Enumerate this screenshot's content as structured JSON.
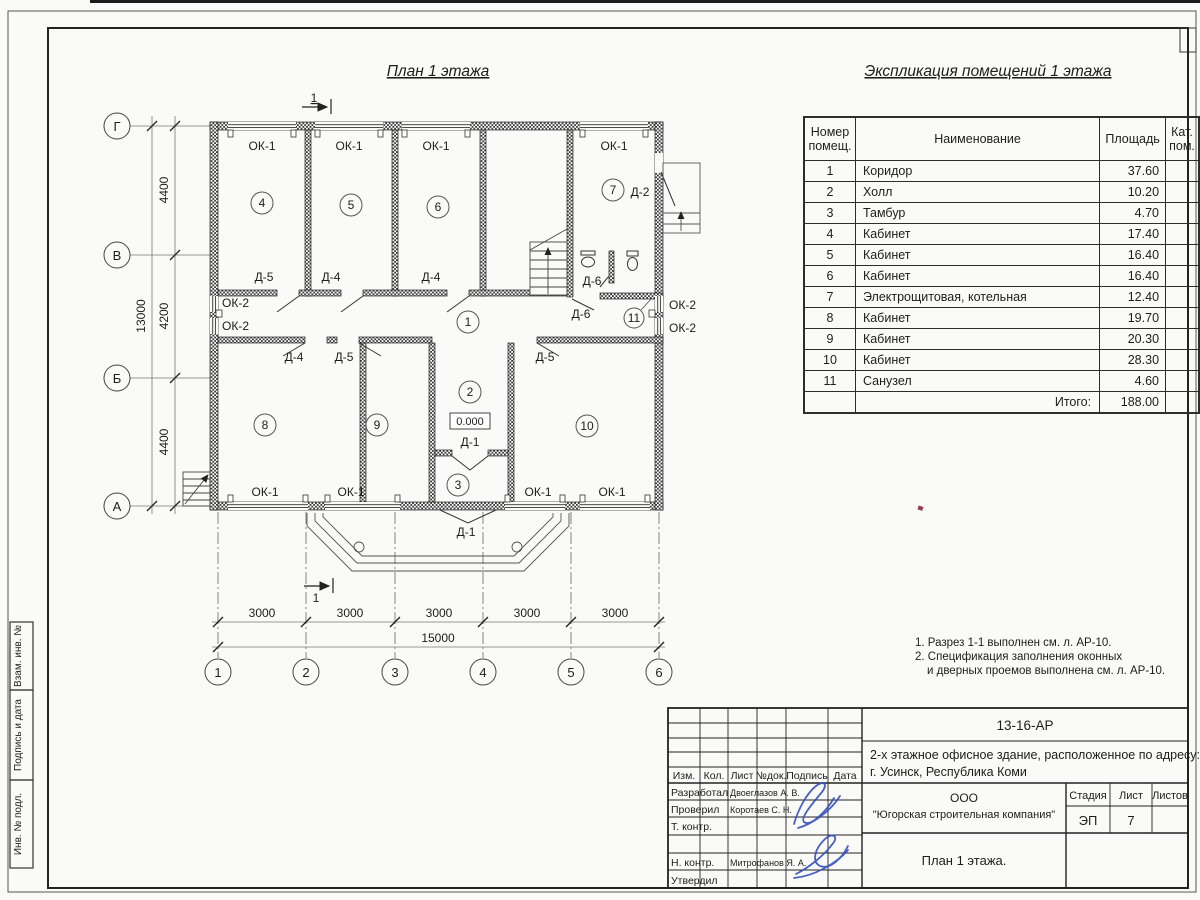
{
  "sheet": {
    "plan_title": "План 1 этажа",
    "table_title": "Экспликация помещений 1 этажа"
  },
  "plan": {
    "axes_rows": [
      "Г",
      "В",
      "Б",
      "А"
    ],
    "axes_cols": [
      "1",
      "2",
      "3",
      "4",
      "5",
      "6"
    ],
    "dims": {
      "v": [
        "4400",
        "4200",
        "4400"
      ],
      "v_total": "13000",
      "h": [
        "3000",
        "3000",
        "3000",
        "3000",
        "3000"
      ],
      "h_total": "15000"
    },
    "labels": {
      "ok1": "ОК-1",
      "ok2": "ОК-2",
      "d1": "Д-1",
      "d2": "Д-2",
      "d4": "Д-4",
      "d5": "Д-5",
      "d6": "Д-6",
      "elevation": "0.000",
      "section": "1"
    }
  },
  "table": {
    "headers": {
      "num": "Номер помещ.",
      "name": "Наименование",
      "area": "Площадь",
      "cat": "Кат. пом."
    },
    "rows": [
      {
        "num": "1",
        "name": "Коридор",
        "area": "37.60"
      },
      {
        "num": "2",
        "name": "Холл",
        "area": "10.20"
      },
      {
        "num": "3",
        "name": "Тамбур",
        "area": "4.70"
      },
      {
        "num": "4",
        "name": "Кабинет",
        "area": "17.40"
      },
      {
        "num": "5",
        "name": "Кабинет",
        "area": "16.40"
      },
      {
        "num": "6",
        "name": "Кабинет",
        "area": "16.40"
      },
      {
        "num": "7",
        "name": "Электрощитовая, котельная",
        "area": "12.40"
      },
      {
        "num": "8",
        "name": "Кабинет",
        "area": "19.70"
      },
      {
        "num": "9",
        "name": "Кабинет",
        "area": "20.30"
      },
      {
        "num": "10",
        "name": "Кабинет",
        "area": "28.30"
      },
      {
        "num": "11",
        "name": "Санузел",
        "area": "4.60"
      }
    ],
    "total_label": "Итого:",
    "total_value": "188.00"
  },
  "notes": [
    "1. Разрез 1-1 выполнен см. л. АР-10.",
    "2. Спецификация заполнения оконных",
    "и дверных проемов выполнена см. л. АР-10."
  ],
  "titleblock": {
    "doc_number": "13-16-АР",
    "project_line1": "2-х этажное офисное здание, расположенное по адресу:",
    "project_line2": "г. Усинск, Республика Коми",
    "columns": [
      "Изм.",
      "Кол.",
      "Лист",
      "№док.",
      "Подпись",
      "Дата"
    ],
    "rows": [
      {
        "role": "Разработал",
        "name": "Двоеглазов А. В."
      },
      {
        "role": "Проверил",
        "name": "Коротаев С. Н."
      },
      {
        "role": "Т. контр.",
        "name": ""
      },
      {
        "role": "",
        "name": ""
      },
      {
        "role": "Н. контр.",
        "name": "Митрофанов Я. А."
      },
      {
        "role": "Утвердил",
        "name": ""
      }
    ],
    "company_line1": "ООО",
    "company_line2": "\"Югорская строительная компания\"",
    "stage_label": "Стадия",
    "sheet_label": "Лист",
    "sheets_label": "Листов",
    "stage_value": "ЭП",
    "sheet_value": "7",
    "sheets_value": "",
    "drawing_title": "План 1 этажа."
  },
  "margin_boxes": [
    "Взам. инв. №",
    "Подпись и дата",
    "Инв. № подл."
  ],
  "colors": {
    "line": "#2b2b2b",
    "signature": "#3550bb",
    "speck": "#983a50"
  }
}
